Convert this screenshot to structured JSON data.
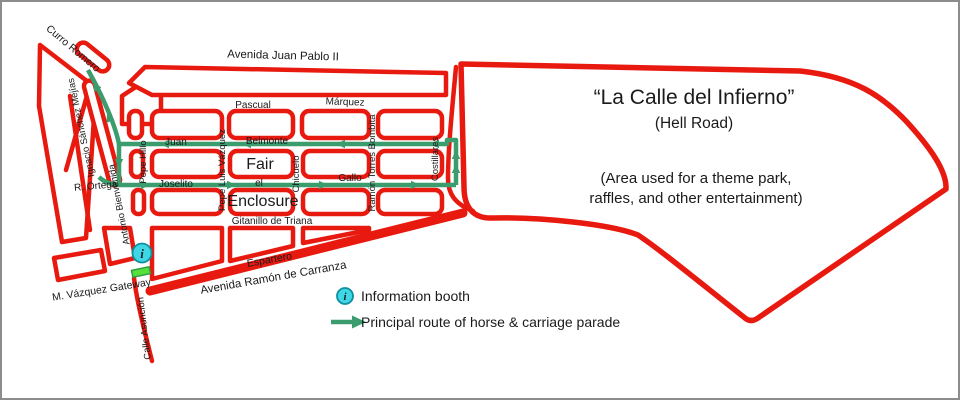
{
  "map": {
    "labels": {
      "curro_romero": "Curro Romero",
      "ignacio": "Ignacio Sánchez Mejías",
      "avenida_juan_pablo": "Avenida Juan Pablo II",
      "pascual": "Pascual",
      "marquez": "Márquez",
      "juan": "Juan",
      "belmonte": "Belmonte",
      "r_ortega": "R. Ortega",
      "antonio_bienvenida": "Antonio Bienvenida",
      "pepe_hillo": "Pepe Hillo",
      "pepe_luis_vazquez": "Pepe Luis Vázquez",
      "joselito": "Joselito",
      "fair": "Fair",
      "el": "el",
      "enclosure": "Enclosure",
      "chicuelo": "Chicuelo",
      "gallo": "Gallo",
      "ramon_torres_bombita": "Ramón Torres  Bombita",
      "costillares": "Costillares",
      "gitanillo": "Gitanillo de Triana",
      "espartero": "Espartero",
      "avenida_carranza": "Avenida Ramón de Carranza",
      "gateway": "M. Vázquez  Gateway",
      "calle_asuncion": "Calle Asunción"
    },
    "info_symbol": "i"
  },
  "infierno": {
    "title": "“La Calle del Infierno”",
    "subtitle": "(Hell Road)",
    "desc_line1": "(Area used for a theme park,",
    "desc_line2": "raffles, and other entertainment)"
  },
  "legend": {
    "info_symbol": "i",
    "info_label": "Information booth",
    "route_label": "Principal route of horse & carriage parade"
  },
  "colors": {
    "street_red": "#e8190f",
    "route_green": "#3b9c6d",
    "info_cyan": "#3fd6e6",
    "gateway_green": "#55e03c"
  }
}
